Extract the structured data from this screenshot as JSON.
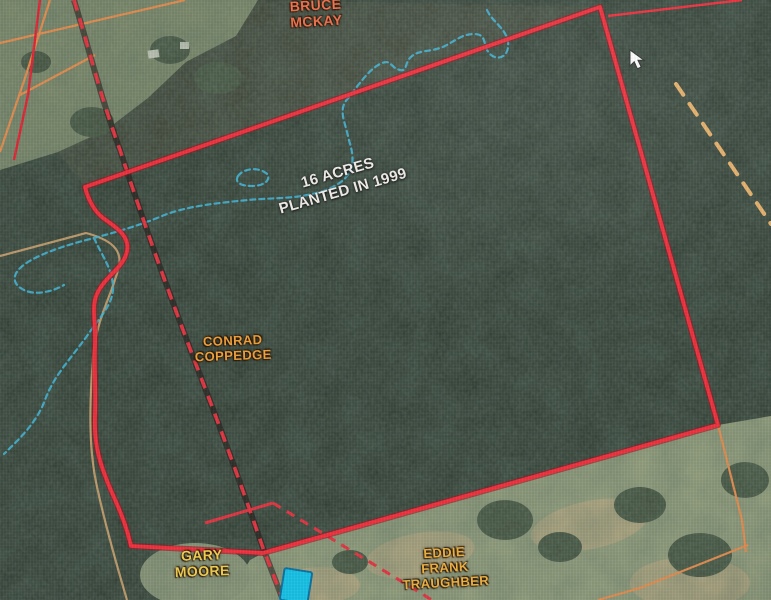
{
  "map": {
    "annotation": {
      "line1": "16 ACRES",
      "line2": "PLANTED IN 1999",
      "color": "#f3eeec"
    },
    "owner_labels": [
      {
        "id": "bruce-mckay",
        "lines": [
          "BRUCE",
          "MCKAY"
        ],
        "color": "#f0714b"
      },
      {
        "id": "conrad-coppedge",
        "lines": [
          "CONRAD",
          "COPPEDGE"
        ],
        "color": "#f0a23a"
      },
      {
        "id": "gary-moore",
        "lines": [
          "GARY",
          "MOORE"
        ],
        "color": "#f2cf52"
      },
      {
        "id": "eddie-frank-traughber",
        "lines": [
          "EDDIE",
          "FRANK",
          "TRAUGHBER"
        ],
        "color": "#eeb242"
      }
    ],
    "colors": {
      "parcel_boundary_red": "#ef3340",
      "boundary_underlay": "#a01622",
      "road_dashed_red": "#e03844",
      "parcel_line_orange": "#df8d52",
      "thin_red_line": "#e02838",
      "survey_dashed_yellow": "#e6b26e",
      "creek_blue": "#45b4d4",
      "tan_road": "#d2a874",
      "structure_highlight_fill": "#1ac2e6",
      "structure_highlight_stroke": "#1272a0",
      "forest_base": "#2e3a31",
      "field_light": "#96a07c"
    },
    "paths": {
      "boundary": "M85,187 L600,7 L718,425 L263,553 L131,546 C124,515 112,495 106,478 C98,458 94,440 95,415 C96,390 94,365 95,345 C96,318 90,305 99,290 C108,274 124,267 127,251 C130,236 116,227 103,218 C94,211 88,199 85,187 Z",
      "boundary_ext": "M608,16 L742,0",
      "road": "M74,0 C90,52 100,95 120,150 C146,230 172,302 205,388 C228,448 247,502 263,548 L283,600",
      "gary_corner": "M205,523 L273,503",
      "road_spur_dashed": "M273,503 L432,600",
      "orange_a": "M0,43 L185,0",
      "orange_b": "M20,95 L95,55",
      "orange_c": "M50,0 L26,75 L0,152",
      "thin_red_d": "M40,0 L28,95 L14,160",
      "orange_corner_1": "M718,425 L742,520 L746,552",
      "orange_corner_2": "M748,545 L640,588 L598,600",
      "tan_road": "M0,256 L86,233 C112,240 122,250 119,266 C112,296 96,318 93,358 C90,398 88,442 96,482 C103,516 114,556 127,600",
      "yellow_dashed": "M676,84 L771,224",
      "creek_main": "M487,10 C492,22 506,28 508,42 C510,56 498,62 490,54 C482,46 488,34 474,34 C460,34 452,44 440,48 C428,52 420,50 412,56 C404,62 408,72 400,70 C390,68 392,58 380,64 C368,70 358,86 345,102 C340,112 344,120 347,132 C350,146 354,152 352,166 C348,182 330,190 312,194 C290,199 268,198 248,200 C218,203 186,206 162,216 C138,226 116,232 94,238 C70,244 44,252 28,262 C12,272 10,283 24,290 C36,296 54,291 64,285",
      "creek_branch": "M94,238 C102,256 112,268 113,286 C114,304 99,318 87,336 C68,362 54,376 45,400 C36,424 18,440 4,454",
      "creek_pond": "M238,176 C244,168 258,167 266,173 C272,178 266,186 252,186 C242,186 234,183 238,176 Z",
      "field_topleft": "M0,0 L258,0 L236,36 L186,62 L148,98 L106,130 L58,152 L0,170 Z",
      "upper_strip": "M258,0 L600,7 L85,187 L58,152 L106,130 L148,98 L186,62 L236,36 Z",
      "field_bottom": "M225,600 L250,560 L263,553 L718,425 L771,416 L771,600 Z",
      "cursor": "M630,50 l0,16 l4.2,-4.2 l3.2,7 l3.8,-1.8 l-3.2,-6.8 l6,0 Z"
    }
  }
}
